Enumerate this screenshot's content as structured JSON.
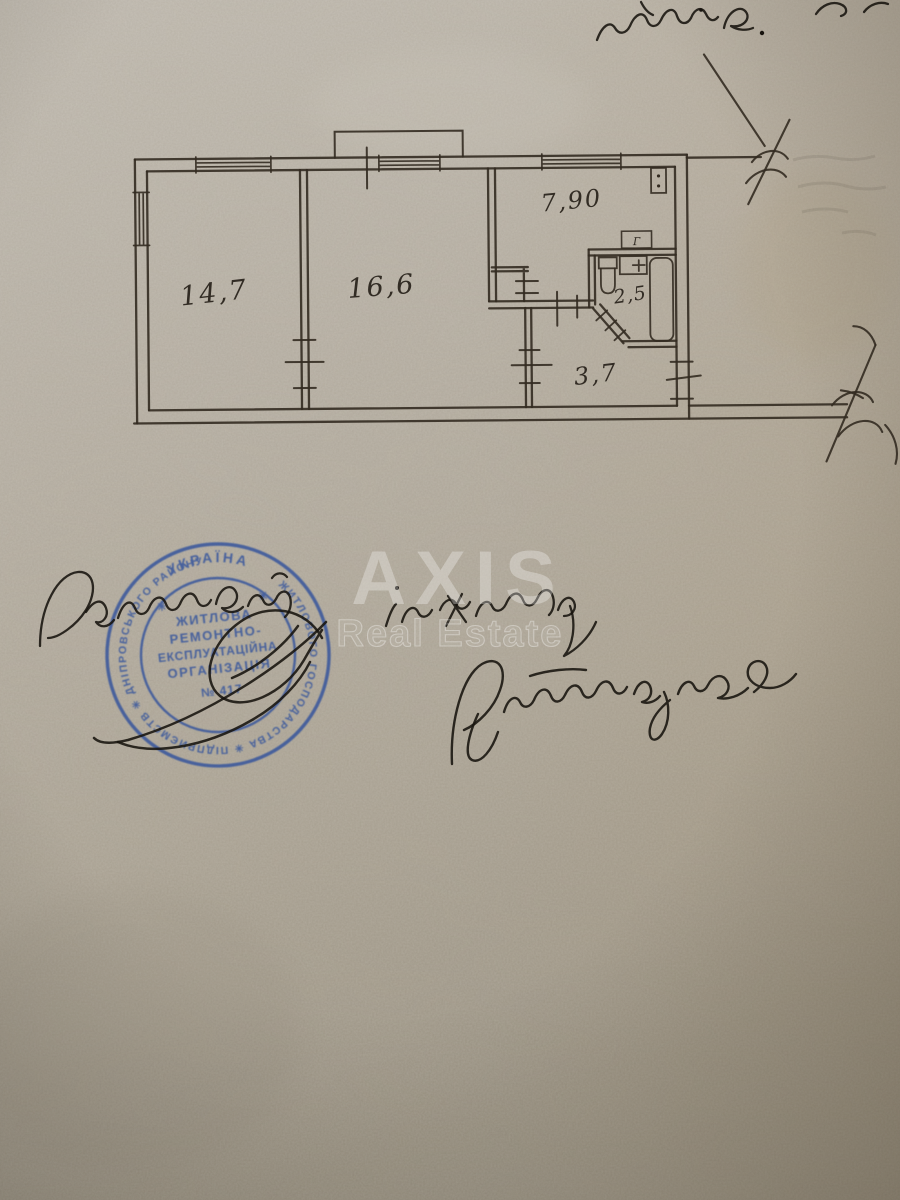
{
  "handwriting": {
    "top_fragment": "нсшків.",
    "title_line": "Головний інженер",
    "signature_name": "Артемчук",
    "stamp_signature": "підпис"
  },
  "floor_plan": {
    "room_areas": {
      "room1": "14,7",
      "room2": "16,6",
      "kitchen": "7,90",
      "bathroom": "2,5",
      "hallway": "3,7"
    },
    "vent_label": "Г"
  },
  "stamp": {
    "color": "#2d4f9c",
    "top_text": "УКРАЇНА",
    "star_left": "✳",
    "star_right": "✳",
    "ring_text": "ЖИТЛОВОГО ГОСПОДАРСТВА ✳ ПІДПРИЄМСТВ ✳ ДНІПРОВСЬКОГО РАЙОНУ",
    "center_lines": [
      "ЖИТЛОВА",
      "РЕМОНТНО-",
      "ЕКСПЛУАТАЦІЙНА",
      "ОРГАНІЗАЦІЯ",
      "№ 417"
    ]
  },
  "watermark": {
    "brand": "AXIS",
    "subtitle": "Real Estate"
  }
}
